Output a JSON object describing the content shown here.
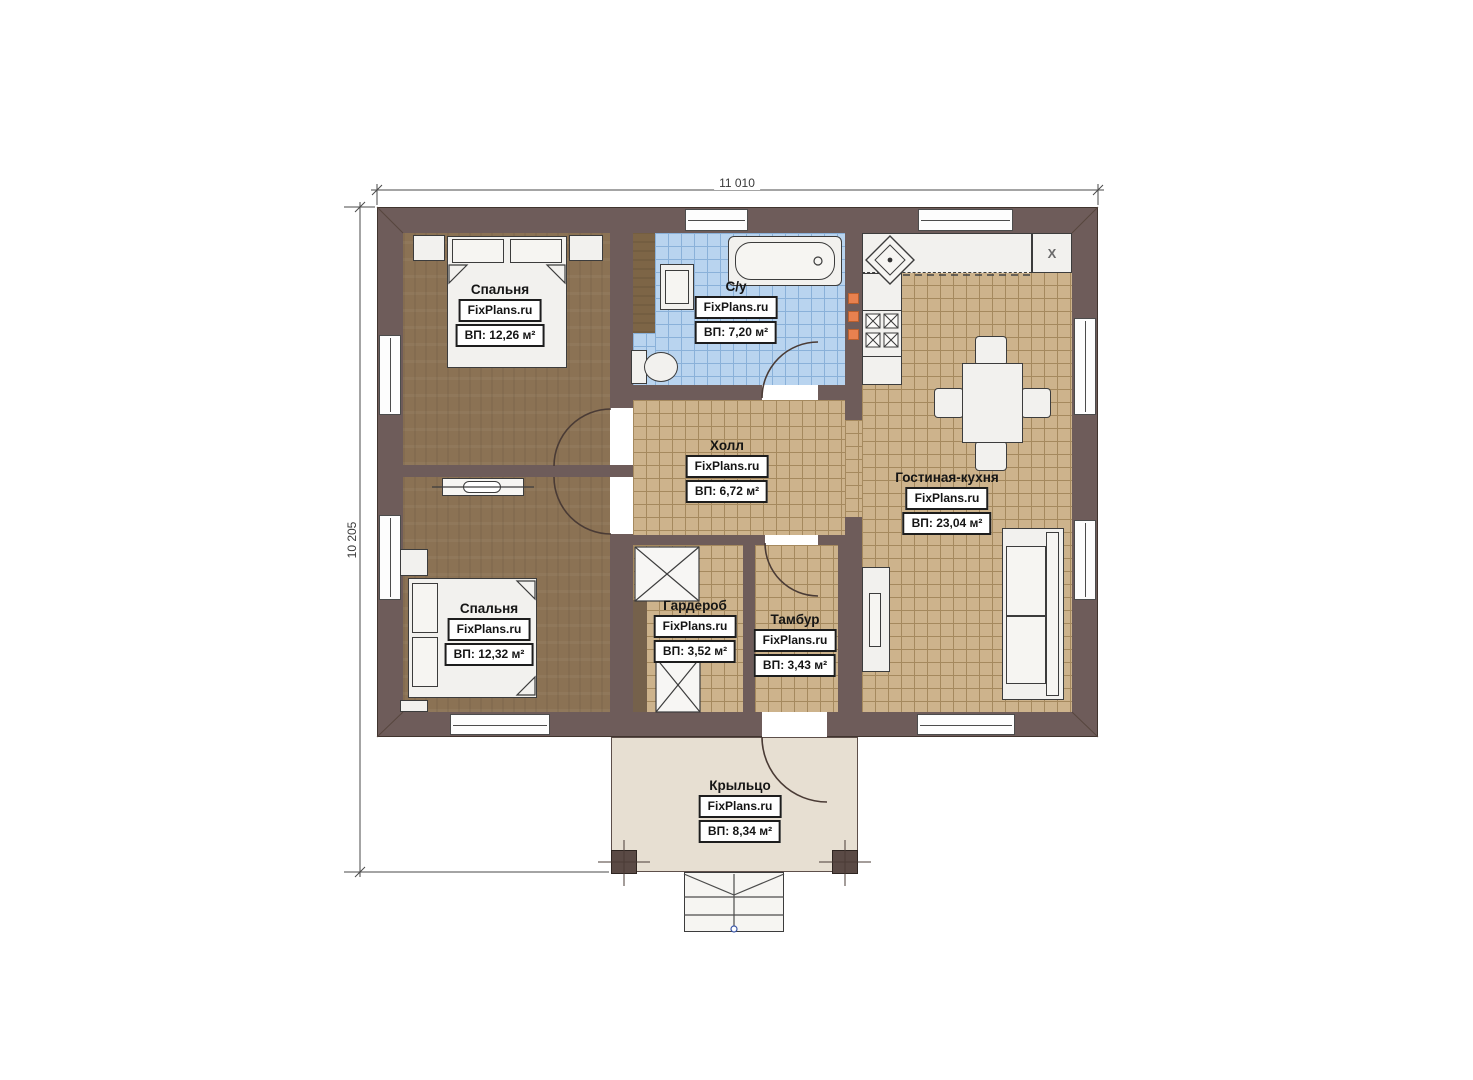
{
  "dimensions": {
    "width_label": "11 010",
    "height_label": "10 205"
  },
  "rooms": [
    {
      "name": "Спальня",
      "source": "FixPlans.ru",
      "area": "ВП: 12,26 м²"
    },
    {
      "name": "С/у",
      "source": "FixPlans.ru",
      "area": "ВП: 7,20 м²"
    },
    {
      "name": "Холл",
      "source": "FixPlans.ru",
      "area": "ВП: 6,72 м²"
    },
    {
      "name": "Гостиная-кухня",
      "source": "FixPlans.ru",
      "area": "ВП: 23,04 м²"
    },
    {
      "name": "Спальня",
      "source": "FixPlans.ru",
      "area": "ВП: 12,32 м²"
    },
    {
      "name": "Гардероб",
      "source": "FixPlans.ru",
      "area": "ВП: 3,52 м²"
    },
    {
      "name": "Тамбур",
      "source": "FixPlans.ru",
      "area": "ВП: 3,43 м²"
    },
    {
      "name": "Крыльцо",
      "source": "FixPlans.ru",
      "area": "ВП: 8,34 м²"
    }
  ],
  "kitchen": {
    "appliance_marker": "X"
  },
  "colors": {
    "wall": "#6e5c5a",
    "wood_floor": "#8b7254",
    "tile_floor": "#cdb38c",
    "tile_line": "#a5895e",
    "wet_floor": "#b9d4ef",
    "wet_line": "#8ab1d9",
    "porch_floor": "#e7dfd2",
    "accent_orange": "#e8814f"
  }
}
